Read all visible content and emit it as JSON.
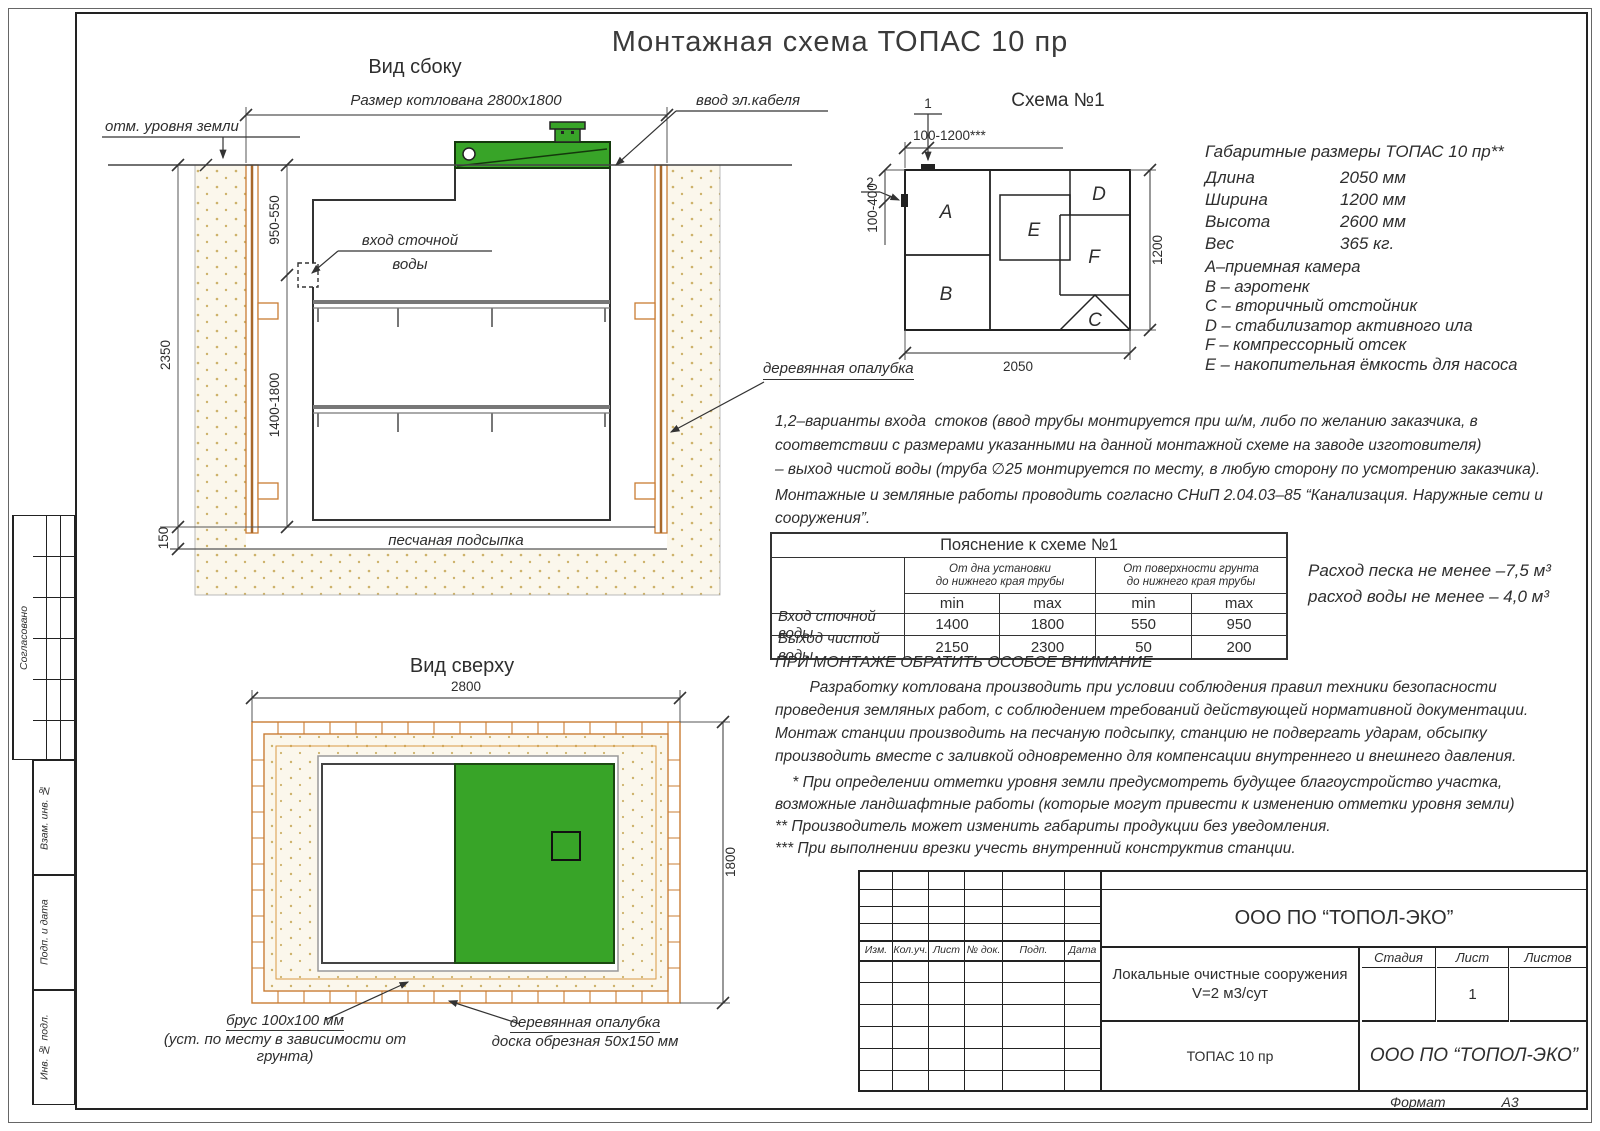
{
  "page": {
    "title": "Монтажная схема ТОПАС 10 пр",
    "format_label": "Формат",
    "format_value": "А3"
  },
  "side_view": {
    "title": "Вид сбоку",
    "pit_dim": "Размер котлована 2800х1800",
    "ground_label": "отм. уровня земли",
    "cable_label": "ввод эл.кабеля",
    "inlet_line1": "вход сточной",
    "inlet_line2": "воды",
    "formwork_label": "деревянная опалубка",
    "sand_label": "песчаная подсыпка",
    "dim_depth": "2350",
    "dim_inlet": "950-550",
    "dim_lower": "1400-1800",
    "dim_bed": "150"
  },
  "schema": {
    "title": "Схема №1",
    "marker1": "1",
    "marker2": "2",
    "dim_top": "100-1200***",
    "dim_left": "100-400",
    "dim_right": "1200",
    "dim_bottom": "2050",
    "c_a": "A",
    "c_b": "B",
    "c_c": "C",
    "c_d": "D",
    "c_e": "E",
    "c_f": "F"
  },
  "specs": {
    "title": "Габаритные размеры ТОПАС 10 пр**",
    "rows": [
      {
        "label": "Длина",
        "value": "2050 мм"
      },
      {
        "label": "Ширина",
        "value": "1200 мм"
      },
      {
        "label": "Высота",
        "value": "2600 мм"
      },
      {
        "label": "Вес",
        "value": "365 кг."
      }
    ],
    "legend": [
      "А–приемная  камера",
      "В – аэротенк",
      "С – вторичный отстойник",
      "D – стабилизатор активного  ила",
      "F  – компрессорный отсек",
      "Е – накопительная ёмкость для насоса"
    ]
  },
  "paragraphs": {
    "variants": "1,2–варианты входа  стоков (ввод трубы монтируется при ш/м, либо по желанию заказчика, в\nсоответствии с размерами указанными на данной монтажной схеме на заводе изготовителя)\n– выход чистой воды (труба ∅25 монтируется по месту, в любую сторону по усмотрению заказчика).",
    "snip": "Монтажные и земляные работы проводить согласно СНиП 2.04.03–85 “Канализация. Наружные сети и\nсооружения”.",
    "attention_title": "ПРИ МОНТАЖЕ ОБРАТИТЬ ОСОБОЕ ВНИМАНИЕ",
    "attention_body": "        Разработку котлована производить при условии соблюдения правил техники безопасности\nпроведения земляных работ, с соблюдением требований действующей нормативной документации.\nМонтаж станции производить на песчаную подсыпку, станцию не подвергать ударам, обсыпку\nпроизводить вместе с заливкой одновременно для компенсации внутреннего и внешнего давления.",
    "footnotes": "    * При определении отметки уровня земли предусмотреть будущее благоустройство участка,\nвозможные ландшафтные работы (которые могут привести к изменению отметки уровня земли)\n** Производитель может изменить габариты продукции без уведомления.\n*** При выполнении врезки учесть внутренний конструктив станции.",
    "consumption": "Расход песка не менее –7,5 м³\nрасход воды не менее – 4,0 м³"
  },
  "table": {
    "title": "Пояснение к схеме №1",
    "group1": "От дна установки\nдо нижнего края трубы",
    "group2": "От поверхности грунта\nдо нижнего края трубы",
    "min": "min",
    "max": "max",
    "rows": [
      {
        "label": "Вход сточной воды",
        "values": [
          "1400",
          "1800",
          "550",
          "950"
        ]
      },
      {
        "label": "Выход чистой воды",
        "values": [
          "2150",
          "2300",
          "50",
          "200"
        ]
      }
    ]
  },
  "top_view": {
    "title": "Вид сверху",
    "dim_width": "2800",
    "dim_height": "1800",
    "beam_line1": "брус 100х100 мм",
    "beam_line2": "(уст. по месту в зависимости от грунта)",
    "formwork_line1": "деревянная опалубка",
    "formwork_line2": "доска обрезная 50х150 мм"
  },
  "stamp": {
    "cols": [
      "Изм.",
      "Кол.уч.",
      "Лист",
      "№ док.",
      "Подп.",
      "Дата"
    ],
    "company": "ООО ПО “ТОПОЛ-ЭКО”",
    "project": "Локальные очистные сооружения\nV=2 м3/сут",
    "stage_label": "Стадия",
    "sheet_label": "Лист",
    "sheets_label": "Листов",
    "sheet_number": "1",
    "product": "ТОПАС 10 пр",
    "company_italic": "ООО ПО “ТОПОЛ-ЭКО”"
  },
  "sidebar": {
    "agreed": "Согласовано",
    "vzam": "Взам. инв. №",
    "podp": "Подп. и дата",
    "inv": "Инв. № подл."
  },
  "colors": {
    "green": "#38a428",
    "wood": "#c97c33",
    "sand_dot": "#cdb26b"
  }
}
